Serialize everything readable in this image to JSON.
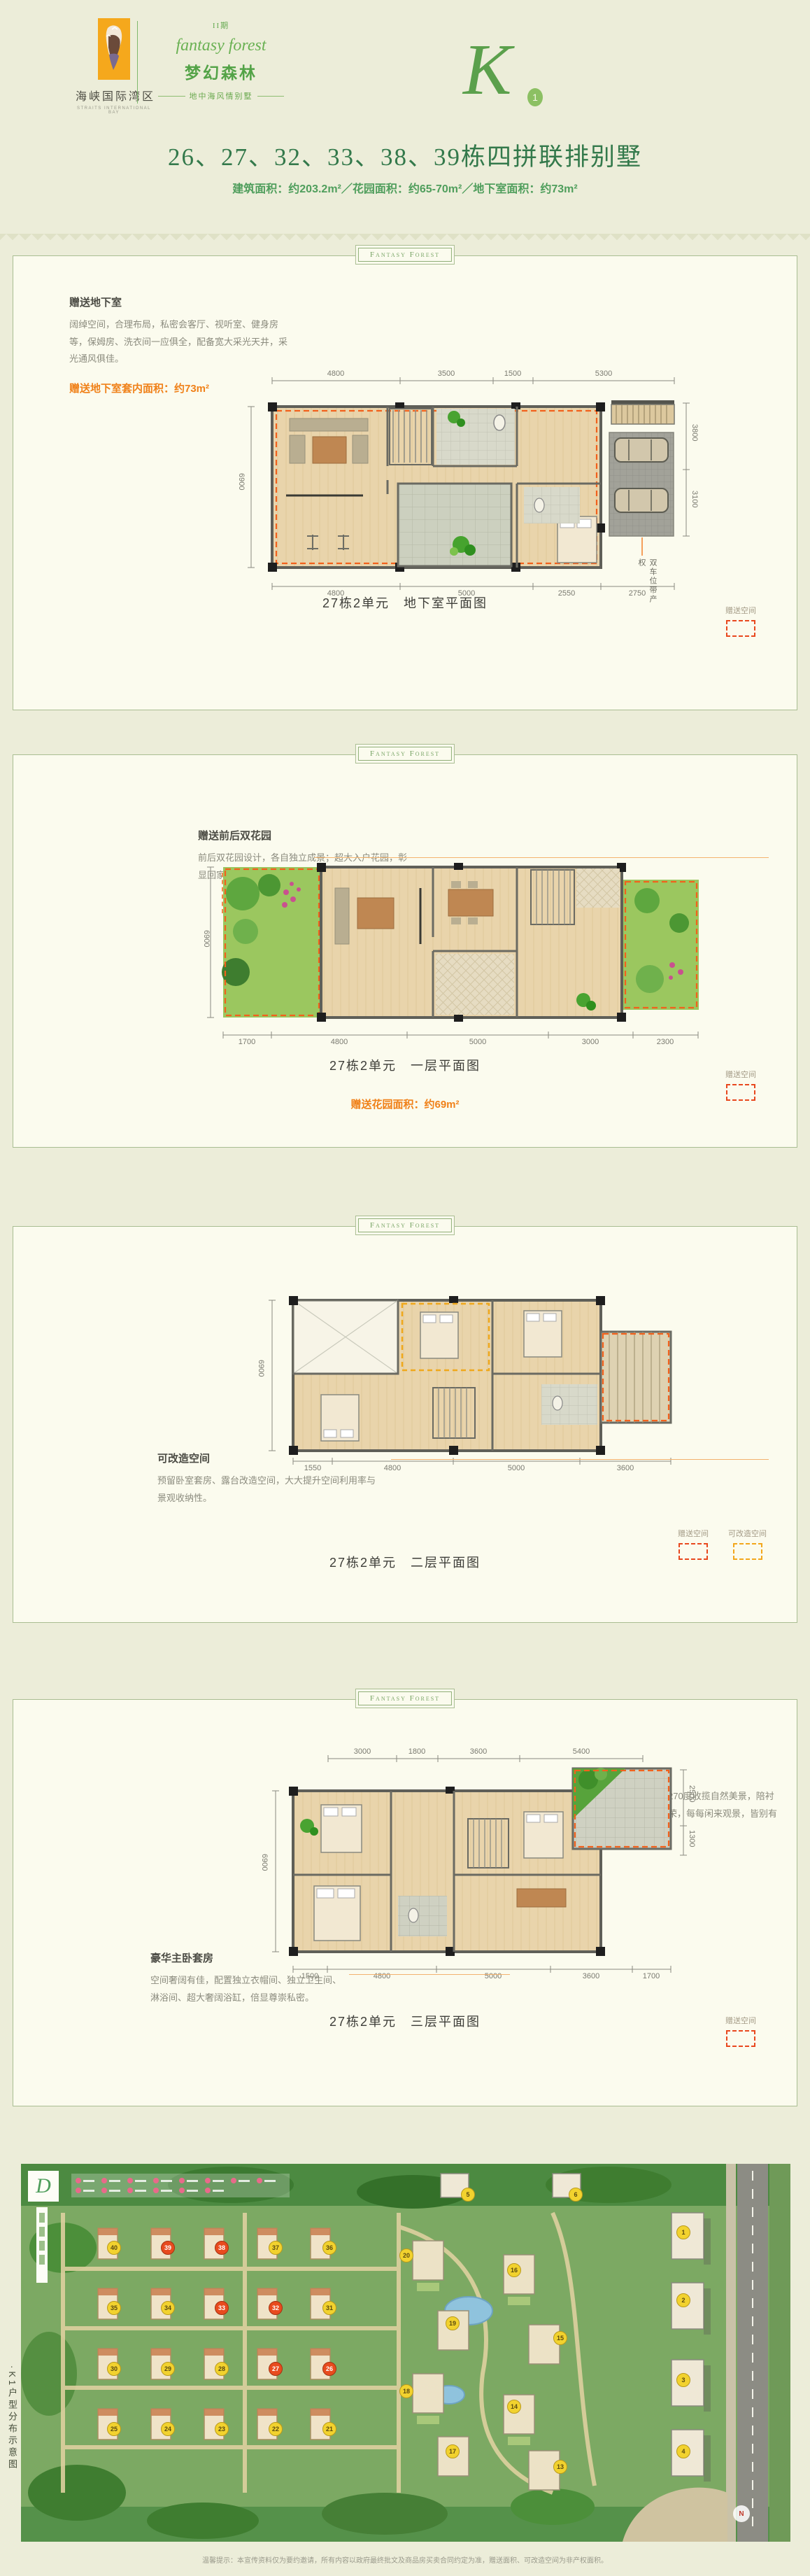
{
  "header": {
    "logo": {
      "name_cn": "海峡国际湾区",
      "name_en": "STRAITS INTERNATIONAL BAY"
    },
    "phase": "II期",
    "brand_script": "fantasy forest",
    "brand_cn": "梦幻森林",
    "brand_sub": "地中海风情别墅",
    "unit_mark": {
      "letter": "K",
      "number": "1"
    }
  },
  "title": {
    "main": "26、27、32、33、38、39栋四拼联排别墅",
    "sub": "建筑面积：约203.2m²／花园面积：约65-70m²／地下室面积：约73m²"
  },
  "badge": "Fantasy Forest",
  "legend": {
    "gift": "赠送空间",
    "convertible": "可改造空间"
  },
  "sections": [
    {
      "caption": "27栋2单元　地下室平面图",
      "note_title": "赠送地下室",
      "note_body": "阔绰空间，合理布局，私密会客厅、视听室、健身房等，保姆房、洗衣间一应俱全，配备宽大采光天井，采光通风俱佳。",
      "note_hl": "赠送地下室套内面积：约73m²",
      "parking_label": "双车位带产权",
      "dims_top": [
        "4800",
        "3500",
        "1500",
        "5300"
      ],
      "dims_bottom": [
        "4800",
        "5000",
        "2550",
        "2750"
      ],
      "dims_left": [
        "6900"
      ],
      "dims_right": [
        "3800",
        "3100"
      ]
    },
    {
      "caption": "27栋2单元　一层平面图",
      "note_title": "赠送前后双花园",
      "note_body": "前后双花园设计，各自独立成景；超大入户花园，彰显回家的至高礼遇。",
      "note_hl": "赠送花园面积：约69m²",
      "dims_bottom": [
        "1700",
        "4800",
        "5000",
        "3000",
        "2300"
      ],
      "dims_left": [
        "6900"
      ]
    },
    {
      "caption": "27栋2单元　二层平面图",
      "note_title": "可改造空间",
      "note_body": "预留卧室套房、露台改造空间，大大提升空间利用率与景观收纳性。",
      "dims_bottom": [
        "1550",
        "4800",
        "5000",
        "3600"
      ],
      "dims_left": [
        "6900"
      ]
    },
    {
      "caption": "27栋2单元　三层平面图",
      "note_title": "拐角景观露台",
      "note_body": "宽大拐角露台，270度收揽自然美景，陪衬书房的惬意与尊荣，每每闲来观景，皆别有一番情趣与格调。",
      "note2_title": "豪华主卧套房",
      "note2_body": "空间奢阔有佳，配置独立衣帽间、独立卫生间、淋浴间、超大奢阔浴缸，倍显尊崇私密。",
      "dims_top": [
        "3000",
        "1800",
        "3600",
        "5400"
      ],
      "dims_bottom": [
        "1500",
        "4800",
        "5000",
        "3600",
        "1700"
      ],
      "dims_left": [
        "6900"
      ],
      "dims_right": [
        "2500",
        "1300"
      ]
    }
  ],
  "site_map": {
    "vertical_label": "·K1户型分布示意图",
    "logo_letter": "D",
    "legend_count": 14,
    "compass": "N",
    "markers": [
      {
        "n": "40",
        "x": 12,
        "y": 22
      },
      {
        "n": "39",
        "x": 19,
        "y": 22,
        "hl": true
      },
      {
        "n": "38",
        "x": 26,
        "y": 22,
        "hl": true
      },
      {
        "n": "37",
        "x": 33,
        "y": 22
      },
      {
        "n": "36",
        "x": 40,
        "y": 22
      },
      {
        "n": "35",
        "x": 12,
        "y": 38
      },
      {
        "n": "34",
        "x": 19,
        "y": 38
      },
      {
        "n": "33",
        "x": 26,
        "y": 38,
        "hl": true
      },
      {
        "n": "32",
        "x": 33,
        "y": 38,
        "hl": true
      },
      {
        "n": "31",
        "x": 40,
        "y": 38
      },
      {
        "n": "30",
        "x": 12,
        "y": 54
      },
      {
        "n": "29",
        "x": 19,
        "y": 54
      },
      {
        "n": "28",
        "x": 26,
        "y": 54
      },
      {
        "n": "27",
        "x": 33,
        "y": 54,
        "hl": true
      },
      {
        "n": "26",
        "x": 40,
        "y": 54,
        "hl": true
      },
      {
        "n": "25",
        "x": 12,
        "y": 70
      },
      {
        "n": "24",
        "x": 19,
        "y": 70
      },
      {
        "n": "23",
        "x": 26,
        "y": 70
      },
      {
        "n": "22",
        "x": 33,
        "y": 70
      },
      {
        "n": "21",
        "x": 40,
        "y": 70
      },
      {
        "n": "20",
        "x": 50,
        "y": 24
      },
      {
        "n": "19",
        "x": 56,
        "y": 42
      },
      {
        "n": "18",
        "x": 50,
        "y": 60
      },
      {
        "n": "17",
        "x": 56,
        "y": 76
      },
      {
        "n": "16",
        "x": 64,
        "y": 28
      },
      {
        "n": "15",
        "x": 70,
        "y": 46
      },
      {
        "n": "14",
        "x": 64,
        "y": 64
      },
      {
        "n": "13",
        "x": 70,
        "y": 80
      },
      {
        "n": "1",
        "x": 86,
        "y": 18
      },
      {
        "n": "2",
        "x": 86,
        "y": 36
      },
      {
        "n": "3",
        "x": 86,
        "y": 57
      },
      {
        "n": "4",
        "x": 86,
        "y": 76
      },
      {
        "n": "5",
        "x": 58,
        "y": 8
      },
      {
        "n": "6",
        "x": 72,
        "y": 8
      }
    ],
    "disclaimer": "温馨提示：本宣传资料仅为要约邀请，所有内容以政府最终批文及商品房买卖合同约定为准，赠送面积、可改造空间为非产权面积。"
  }
}
